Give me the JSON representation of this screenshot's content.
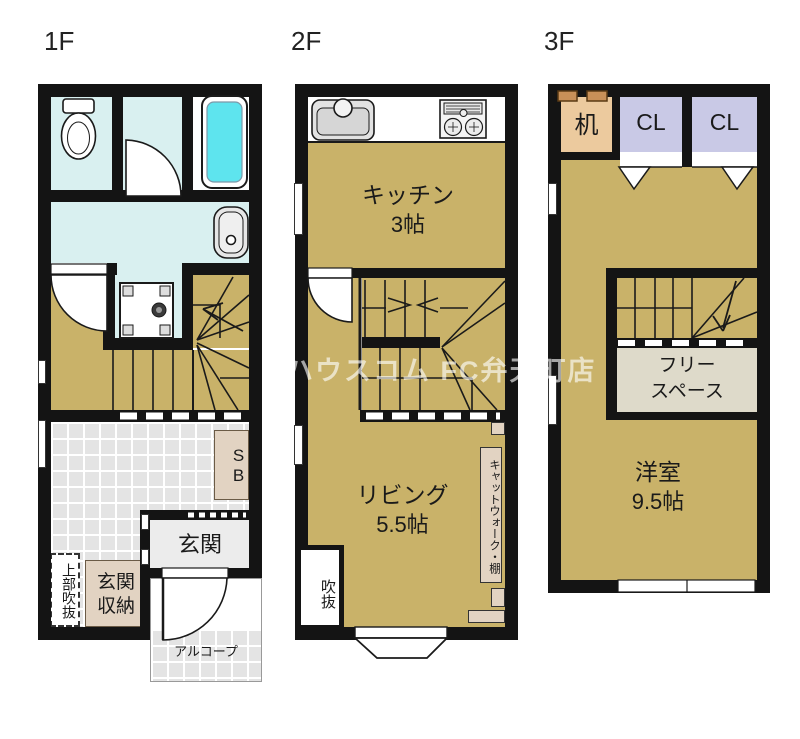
{
  "watermark": "ハウスコム FC弁天町店",
  "colors": {
    "floor_tan": "#c9b269",
    "water_cyan": "#d9f0f0",
    "tub_cyan": "#5ee4ee",
    "tile_gray": "#e4e4e4",
    "entrance_gray": "#ececec",
    "storage_beige": "#e2d3c2",
    "free_space_beige": "#dedaca",
    "desk_peach": "#ecca9e",
    "closet_lavender": "#c9c9e6",
    "wall_black": "#141414"
  },
  "floors": {
    "f1": {
      "label": "1F",
      "entrance": "玄関",
      "entrance_storage": "玄関収納",
      "upper_void": "上部吹抜",
      "alcove": "アルコープ",
      "shoe_box": "SB"
    },
    "f2": {
      "label": "2F",
      "kitchen_name": "キッチン",
      "kitchen_size": "3帖",
      "living_name": "リビング",
      "living_size": "5.5帖",
      "void": "吹抜",
      "catwalk_shelf": "キャットウォーク・棚"
    },
    "f3": {
      "label": "3F",
      "desk": "机",
      "closet_left": "CL",
      "closet_right": "CL",
      "free_space_line1": "フリー",
      "free_space_line2": "スペース",
      "room_name": "洋室",
      "room_size": "9.5帖"
    }
  }
}
